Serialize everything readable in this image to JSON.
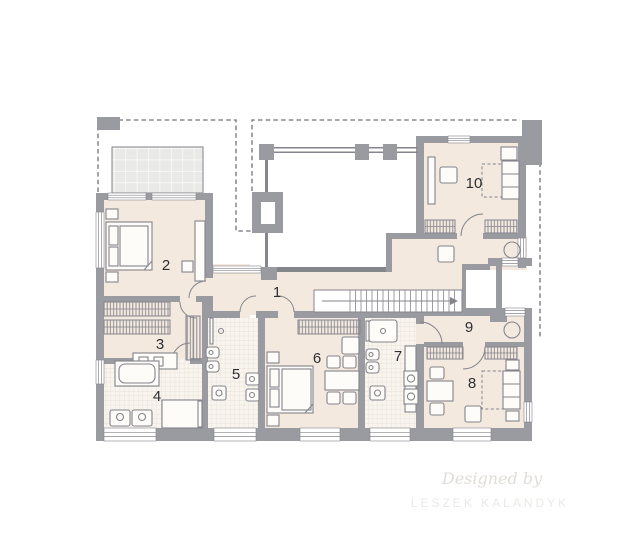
{
  "plan": {
    "room_labels": [
      {
        "id": "room-1",
        "label": "1"
      },
      {
        "id": "room-2",
        "label": "2"
      },
      {
        "id": "room-3",
        "label": "3"
      },
      {
        "id": "room-4",
        "label": "4"
      },
      {
        "id": "room-5",
        "label": "5"
      },
      {
        "id": "room-6",
        "label": "6"
      },
      {
        "id": "room-7",
        "label": "7"
      },
      {
        "id": "room-8",
        "label": "8"
      },
      {
        "id": "room-9",
        "label": "9"
      },
      {
        "id": "room-10",
        "label": "10"
      }
    ],
    "watermark": {
      "line1": "Designed by",
      "line2": "LESZEK KALANDYK"
    }
  },
  "colors": {
    "floor": "#f3e9de",
    "tile": "#f8f4ee",
    "tile_line": "#e6dbcf",
    "terrace": "#e9e9e7",
    "terrace_line": "#ffffff",
    "wall": "#9a9aa1",
    "wall_dark": "#85858d",
    "furniture": "#84848c",
    "furniture_fill": "#fdfcf9",
    "label": "#2e2e33",
    "dash": "#70707a",
    "watermark_script": "#e0ddd9",
    "watermark_caps": "#ebe9e6"
  }
}
